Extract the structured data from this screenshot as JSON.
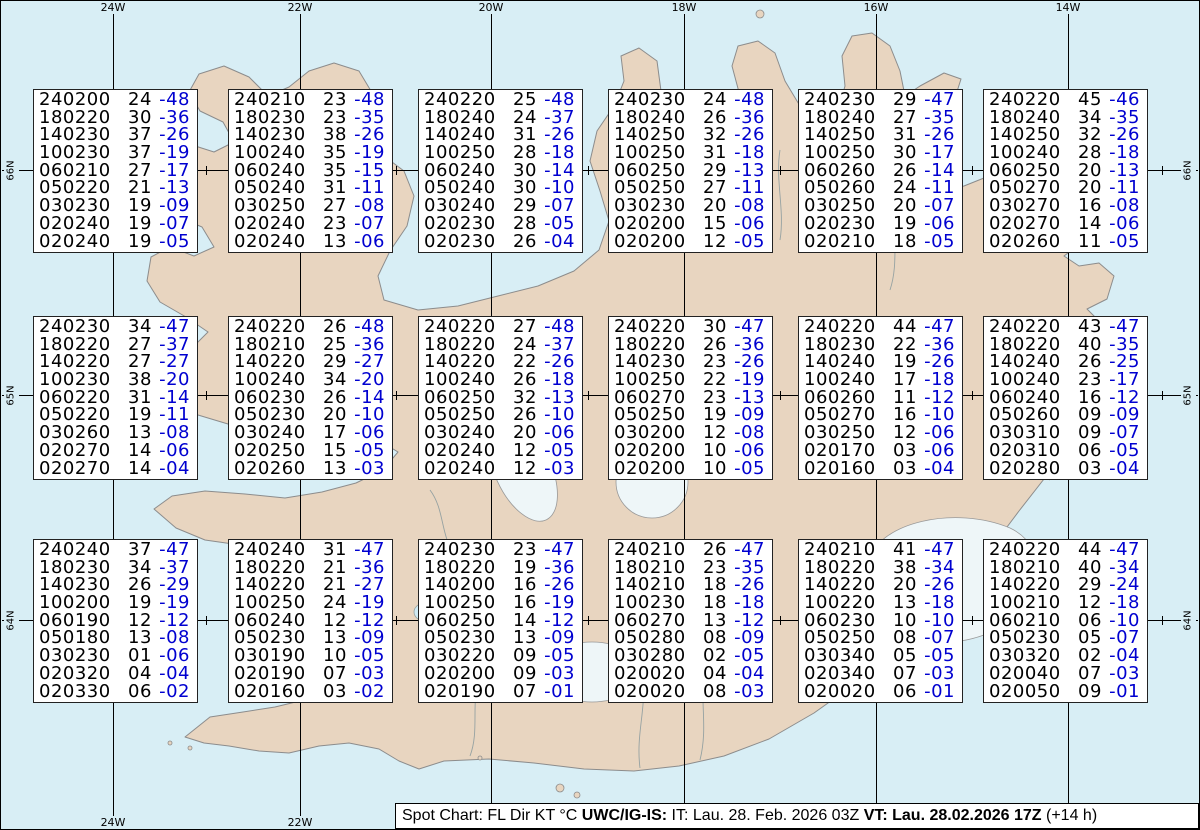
{
  "title": "Spot Chart Iceland upper winds and temperatures",
  "colors": {
    "ocean": "#d8eef5",
    "land": "#e8d5c0",
    "glacier": "#eef6f8",
    "grid": "#000000",
    "temperature_text": "#0000d0",
    "box_background": "#ffffff"
  },
  "map": {
    "meridians": [
      {
        "label": "24W",
        "x": 113
      },
      {
        "label": "22W",
        "x": 300
      },
      {
        "label": "20W",
        "x": 491
      },
      {
        "label": "18W",
        "x": 684
      },
      {
        "label": "16W",
        "x": 876
      },
      {
        "label": "14W",
        "x": 1068
      }
    ],
    "parallels": [
      {
        "label": "66N",
        "y": 170
      },
      {
        "label": "65N",
        "y": 395
      },
      {
        "label": "64N",
        "y": 620
      }
    ],
    "degree_xs": [
      18,
      113,
      206,
      300,
      396,
      491,
      588,
      684,
      780,
      876,
      972,
      1068,
      1162
    ]
  },
  "chart_data": {
    "type": "table",
    "title": "Spot Chart: FL Dir KT °C",
    "columns": [
      "FL+Dir",
      "KT",
      "°C"
    ],
    "points": [
      {
        "lat": "66N",
        "lon": "24W",
        "px": 33,
        "py": 89,
        "lines": [
          [
            "240200",
            "24",
            "-48"
          ],
          [
            "180220",
            "30",
            "-36"
          ],
          [
            "140230",
            "37",
            "-26"
          ],
          [
            "100230",
            "37",
            "-19"
          ],
          [
            "060210",
            "27",
            "-17"
          ],
          [
            "050220",
            "21",
            "-13"
          ],
          [
            "030230",
            "19",
            "-09"
          ],
          [
            "020240",
            "19",
            "-07"
          ],
          [
            "020240",
            "19",
            "-05"
          ]
        ]
      },
      {
        "lat": "66N",
        "lon": "22W",
        "px": 228,
        "py": 89,
        "lines": [
          [
            "240210",
            "23",
            "-48"
          ],
          [
            "180230",
            "23",
            "-35"
          ],
          [
            "140230",
            "38",
            "-26"
          ],
          [
            "100240",
            "35",
            "-19"
          ],
          [
            "060240",
            "35",
            "-15"
          ],
          [
            "050240",
            "31",
            "-11"
          ],
          [
            "030250",
            "27",
            "-08"
          ],
          [
            "020240",
            "23",
            "-07"
          ],
          [
            "020240",
            "13",
            "-06"
          ]
        ]
      },
      {
        "lat": "66N",
        "lon": "20W",
        "px": 418,
        "py": 89,
        "lines": [
          [
            "240220",
            "25",
            "-48"
          ],
          [
            "180240",
            "24",
            "-37"
          ],
          [
            "140240",
            "31",
            "-26"
          ],
          [
            "100250",
            "28",
            "-18"
          ],
          [
            "060240",
            "30",
            "-14"
          ],
          [
            "050240",
            "30",
            "-10"
          ],
          [
            "030240",
            "29",
            "-07"
          ],
          [
            "020230",
            "28",
            "-05"
          ],
          [
            "020230",
            "26",
            "-04"
          ]
        ]
      },
      {
        "lat": "66N",
        "lon": "18W",
        "px": 608,
        "py": 89,
        "lines": [
          [
            "240230",
            "24",
            "-48"
          ],
          [
            "180240",
            "26",
            "-36"
          ],
          [
            "140250",
            "32",
            "-26"
          ],
          [
            "100250",
            "31",
            "-18"
          ],
          [
            "060250",
            "29",
            "-13"
          ],
          [
            "050250",
            "27",
            "-11"
          ],
          [
            "030230",
            "20",
            "-08"
          ],
          [
            "020200",
            "15",
            "-06"
          ],
          [
            "020200",
            "12",
            "-05"
          ]
        ]
      },
      {
        "lat": "66N",
        "lon": "16W",
        "px": 798,
        "py": 89,
        "lines": [
          [
            "240230",
            "29",
            "-47"
          ],
          [
            "180240",
            "27",
            "-35"
          ],
          [
            "140250",
            "31",
            "-26"
          ],
          [
            "100250",
            "30",
            "-17"
          ],
          [
            "060260",
            "26",
            "-14"
          ],
          [
            "050260",
            "24",
            "-11"
          ],
          [
            "030250",
            "20",
            "-07"
          ],
          [
            "020230",
            "19",
            "-06"
          ],
          [
            "020210",
            "18",
            "-05"
          ]
        ]
      },
      {
        "lat": "66N",
        "lon": "14W",
        "px": 983,
        "py": 89,
        "lines": [
          [
            "240220",
            "45",
            "-46"
          ],
          [
            "180240",
            "34",
            "-35"
          ],
          [
            "140250",
            "32",
            "-26"
          ],
          [
            "100240",
            "28",
            "-18"
          ],
          [
            "060250",
            "20",
            "-13"
          ],
          [
            "050270",
            "20",
            "-11"
          ],
          [
            "030270",
            "16",
            "-08"
          ],
          [
            "020270",
            "14",
            "-06"
          ],
          [
            "020260",
            "11",
            "-05"
          ]
        ]
      },
      {
        "lat": "65N",
        "lon": "24W",
        "px": 33,
        "py": 316,
        "lines": [
          [
            "240230",
            "34",
            "-47"
          ],
          [
            "180220",
            "27",
            "-37"
          ],
          [
            "140220",
            "27",
            "-27"
          ],
          [
            "100230",
            "38",
            "-20"
          ],
          [
            "060220",
            "31",
            "-14"
          ],
          [
            "050220",
            "19",
            "-11"
          ],
          [
            "030260",
            "13",
            "-08"
          ],
          [
            "020270",
            "14",
            "-06"
          ],
          [
            "020270",
            "14",
            "-04"
          ]
        ]
      },
      {
        "lat": "65N",
        "lon": "22W",
        "px": 228,
        "py": 316,
        "lines": [
          [
            "240220",
            "26",
            "-48"
          ],
          [
            "180210",
            "25",
            "-36"
          ],
          [
            "140220",
            "29",
            "-27"
          ],
          [
            "100240",
            "34",
            "-20"
          ],
          [
            "060230",
            "26",
            "-14"
          ],
          [
            "050230",
            "20",
            "-10"
          ],
          [
            "030240",
            "17",
            "-06"
          ],
          [
            "020250",
            "15",
            "-05"
          ],
          [
            "020260",
            "13",
            "-03"
          ]
        ]
      },
      {
        "lat": "65N",
        "lon": "20W",
        "px": 418,
        "py": 316,
        "lines": [
          [
            "240220",
            "27",
            "-48"
          ],
          [
            "180220",
            "24",
            "-37"
          ],
          [
            "140220",
            "22",
            "-26"
          ],
          [
            "100240",
            "26",
            "-18"
          ],
          [
            "060250",
            "32",
            "-13"
          ],
          [
            "050250",
            "26",
            "-10"
          ],
          [
            "030240",
            "20",
            "-06"
          ],
          [
            "020240",
            "12",
            "-05"
          ],
          [
            "020240",
            "12",
            "-03"
          ]
        ]
      },
      {
        "lat": "65N",
        "lon": "18W",
        "px": 608,
        "py": 316,
        "lines": [
          [
            "240220",
            "30",
            "-47"
          ],
          [
            "180220",
            "26",
            "-36"
          ],
          [
            "140230",
            "23",
            "-26"
          ],
          [
            "100250",
            "22",
            "-19"
          ],
          [
            "060270",
            "23",
            "-13"
          ],
          [
            "050250",
            "19",
            "-09"
          ],
          [
            "030200",
            "12",
            "-08"
          ],
          [
            "020200",
            "10",
            "-06"
          ],
          [
            "020200",
            "10",
            "-05"
          ]
        ]
      },
      {
        "lat": "65N",
        "lon": "16W",
        "px": 798,
        "py": 316,
        "lines": [
          [
            "240220",
            "44",
            "-47"
          ],
          [
            "180230",
            "22",
            "-36"
          ],
          [
            "140240",
            "19",
            "-26"
          ],
          [
            "100240",
            "17",
            "-18"
          ],
          [
            "060260",
            "11",
            "-12"
          ],
          [
            "050270",
            "16",
            "-10"
          ],
          [
            "030250",
            "12",
            "-06"
          ],
          [
            "020170",
            "03",
            "-06"
          ],
          [
            "020160",
            "03",
            "-04"
          ]
        ]
      },
      {
        "lat": "65N",
        "lon": "14W",
        "px": 983,
        "py": 316,
        "lines": [
          [
            "240220",
            "43",
            "-47"
          ],
          [
            "180220",
            "40",
            "-35"
          ],
          [
            "140240",
            "26",
            "-25"
          ],
          [
            "100240",
            "23",
            "-17"
          ],
          [
            "060240",
            "16",
            "-12"
          ],
          [
            "050260",
            "09",
            "-09"
          ],
          [
            "030310",
            "09",
            "-07"
          ],
          [
            "020310",
            "06",
            "-05"
          ],
          [
            "020280",
            "03",
            "-04"
          ]
        ]
      },
      {
        "lat": "64N",
        "lon": "24W",
        "px": 33,
        "py": 539,
        "lines": [
          [
            "240240",
            "37",
            "-47"
          ],
          [
            "180230",
            "34",
            "-37"
          ],
          [
            "140230",
            "26",
            "-29"
          ],
          [
            "100200",
            "19",
            "-19"
          ],
          [
            "060190",
            "12",
            "-12"
          ],
          [
            "050180",
            "13",
            "-08"
          ],
          [
            "030230",
            "01",
            "-06"
          ],
          [
            "020320",
            "04",
            "-04"
          ],
          [
            "020330",
            "06",
            "-02"
          ]
        ]
      },
      {
        "lat": "64N",
        "lon": "22W",
        "px": 228,
        "py": 539,
        "lines": [
          [
            "240240",
            "31",
            "-47"
          ],
          [
            "180220",
            "21",
            "-36"
          ],
          [
            "140220",
            "21",
            "-27"
          ],
          [
            "100250",
            "24",
            "-19"
          ],
          [
            "060240",
            "12",
            "-12"
          ],
          [
            "050230",
            "13",
            "-09"
          ],
          [
            "030190",
            "10",
            "-05"
          ],
          [
            "020190",
            "07",
            "-03"
          ],
          [
            "020160",
            "03",
            "-02"
          ]
        ]
      },
      {
        "lat": "64N",
        "lon": "20W",
        "px": 418,
        "py": 539,
        "lines": [
          [
            "240230",
            "23",
            "-47"
          ],
          [
            "180220",
            "19",
            "-36"
          ],
          [
            "140200",
            "16",
            "-26"
          ],
          [
            "100250",
            "16",
            "-19"
          ],
          [
            "060250",
            "14",
            "-12"
          ],
          [
            "050230",
            "13",
            "-09"
          ],
          [
            "030220",
            "09",
            "-05"
          ],
          [
            "020200",
            "09",
            "-03"
          ],
          [
            "020190",
            "07",
            "-01"
          ]
        ]
      },
      {
        "lat": "64N",
        "lon": "18W",
        "px": 608,
        "py": 539,
        "lines": [
          [
            "240210",
            "26",
            "-47"
          ],
          [
            "180210",
            "23",
            "-35"
          ],
          [
            "140210",
            "18",
            "-26"
          ],
          [
            "100230",
            "18",
            "-18"
          ],
          [
            "060270",
            "13",
            "-12"
          ],
          [
            "050280",
            "08",
            "-09"
          ],
          [
            "030280",
            "02",
            "-05"
          ],
          [
            "020020",
            "04",
            "-04"
          ],
          [
            "020020",
            "08",
            "-03"
          ]
        ]
      },
      {
        "lat": "64N",
        "lon": "16W",
        "px": 798,
        "py": 539,
        "lines": [
          [
            "240210",
            "41",
            "-47"
          ],
          [
            "180220",
            "38",
            "-34"
          ],
          [
            "140220",
            "20",
            "-26"
          ],
          [
            "100220",
            "13",
            "-18"
          ],
          [
            "060230",
            "10",
            "-10"
          ],
          [
            "050250",
            "08",
            "-07"
          ],
          [
            "030340",
            "05",
            "-05"
          ],
          [
            "020340",
            "07",
            "-03"
          ],
          [
            "020020",
            "06",
            "-01"
          ]
        ]
      },
      {
        "lat": "64N",
        "lon": "14W",
        "px": 983,
        "py": 539,
        "lines": [
          [
            "240220",
            "44",
            "-47"
          ],
          [
            "180210",
            "40",
            "-34"
          ],
          [
            "140220",
            "29",
            "-24"
          ],
          [
            "100210",
            "12",
            "-18"
          ],
          [
            "060210",
            "06",
            "-10"
          ],
          [
            "050230",
            "05",
            "-07"
          ],
          [
            "030320",
            "02",
            "-04"
          ],
          [
            "020040",
            "07",
            "-03"
          ],
          [
            "020050",
            "09",
            "-01"
          ]
        ]
      }
    ]
  },
  "caption": {
    "seg1": "Spot Chart: FL Dir KT °C ",
    "seg2": "UWC/IG-IS:",
    "seg3": " IT: Lau. 28. Feb. 2026 03Z ",
    "seg4": "VT: Lau. 28.02.2026 17Z",
    "seg5": " (+14 h)"
  }
}
